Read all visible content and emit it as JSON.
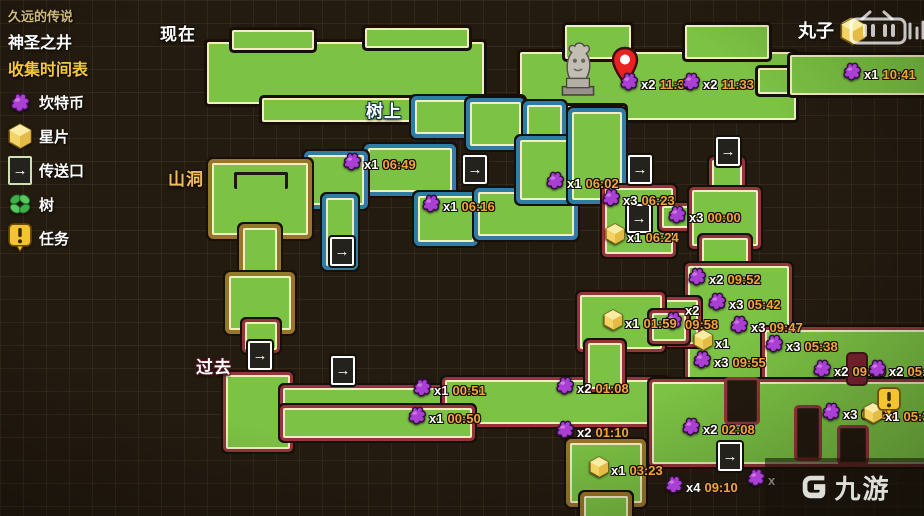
{
  "legend": {
    "series_title": "久远的传说",
    "map_title": "神圣之井",
    "subtitle": "收集时间表",
    "items": [
      {
        "icon": "coin-icon",
        "label": "坎特币"
      },
      {
        "icon": "shard-icon",
        "label": "星片"
      },
      {
        "icon": "teleport-icon",
        "label": "传送口"
      },
      {
        "icon": "tree-icon",
        "label": "树"
      },
      {
        "icon": "quest-icon",
        "label": "任务"
      }
    ]
  },
  "map_labels": [
    {
      "id": "now",
      "text": "现在",
      "x": 160,
      "y": 20,
      "style": "plain"
    },
    {
      "id": "tree-top",
      "text": "树上",
      "x": 366,
      "y": 97,
      "style": "blue"
    },
    {
      "id": "cave",
      "text": "山洞",
      "x": 168,
      "y": 165,
      "style": "tan"
    },
    {
      "id": "past",
      "text": "过去",
      "x": 196,
      "y": 353,
      "style": "red"
    }
  ],
  "markers": {
    "coins": [
      {
        "count": "x2",
        "time": "11:36",
        "x": 618,
        "y": 70
      },
      {
        "count": "x2",
        "time": "11:33",
        "x": 680,
        "y": 70
      },
      {
        "count": "x1",
        "time": "10:41",
        "x": 841,
        "y": 60
      },
      {
        "count": "x1",
        "time": "06:49",
        "x": 341,
        "y": 150
      },
      {
        "count": "x1",
        "time": "06:16",
        "x": 420,
        "y": 192
      },
      {
        "count": "x1",
        "time": "06:02",
        "x": 544,
        "y": 169
      },
      {
        "count": "x3",
        "time": "06:23",
        "x": 600,
        "y": 186
      },
      {
        "count": "x3",
        "time": "00:00",
        "x": 666,
        "y": 203
      },
      {
        "count": "x2",
        "time": "09:52",
        "x": 686,
        "y": 265
      },
      {
        "count": "x3",
        "time": "05:42",
        "x": 706,
        "y": 290
      },
      {
        "count": "x3",
        "time": "09:47",
        "x": 728,
        "y": 313
      },
      {
        "count": "x2",
        "time": "09:58",
        "x": 662,
        "y": 304,
        "stacked": true
      },
      {
        "count": "x3",
        "time": "09:55",
        "x": 691,
        "y": 348
      },
      {
        "count": "x3",
        "time": "05:38",
        "x": 763,
        "y": 332
      },
      {
        "count": "x2",
        "time": "09:39",
        "x": 811,
        "y": 357
      },
      {
        "count": "x2",
        "time": "05:33",
        "x": 866,
        "y": 357
      },
      {
        "count": "x1",
        "time": "00:51",
        "x": 411,
        "y": 376
      },
      {
        "count": "x1",
        "time": "00:50",
        "x": 406,
        "y": 404
      },
      {
        "count": "x2",
        "time": "01:08",
        "x": 554,
        "y": 374
      },
      {
        "count": "x2",
        "time": "01:10",
        "x": 554,
        "y": 418
      },
      {
        "count": "x2",
        "time": "02:08",
        "x": 680,
        "y": 415
      },
      {
        "count": "x4",
        "time": "09:10",
        "x": 663,
        "y": 473
      },
      {
        "count": "x3",
        "time": "09:25",
        "x": 820,
        "y": 400
      },
      {
        "count": "x",
        "time": "",
        "x": 745,
        "y": 466
      }
    ],
    "shards": [
      {
        "count": "x1",
        "time": "06:24",
        "x": 604,
        "y": 223
      },
      {
        "count": "x1",
        "time": "01:59",
        "x": 602,
        "y": 309
      },
      {
        "count": "x1",
        "time": "",
        "x": 692,
        "y": 329
      },
      {
        "count": "x1",
        "time": "03:23",
        "x": 588,
        "y": 456
      },
      {
        "count": "x1",
        "time": "05:31",
        "x": 862,
        "y": 402
      },
      {
        "count": "",
        "time": "",
        "x": 840,
        "y": 17
      }
    ],
    "quests": [
      {
        "x": 877,
        "y": 387
      }
    ],
    "teleports": [
      {
        "x": 330,
        "y": 237
      },
      {
        "x": 463,
        "y": 155
      },
      {
        "x": 628,
        "y": 155
      },
      {
        "x": 716,
        "y": 137
      },
      {
        "x": 627,
        "y": 204
      },
      {
        "x": 248,
        "y": 341
      },
      {
        "x": 331,
        "y": 356
      },
      {
        "x": 718,
        "y": 442
      }
    ],
    "poi": {
      "statue": {
        "x": 557,
        "y": 40
      },
      "pin": {
        "x": 611,
        "y": 45
      }
    }
  },
  "watermarks": {
    "author": "丸子",
    "platform": "bilibili",
    "site": "九游"
  },
  "colors": {
    "platform_green": "#7cc244",
    "outline_cream": "#f2eec2",
    "outline_blue": "#2f7da4",
    "outline_red": "#96343c",
    "outline_brown": "#96762a",
    "coin_purple": "#a93fd3",
    "shard_gold": "#f2d464",
    "time_orange": "#f2a43c",
    "background": "#241b10"
  }
}
